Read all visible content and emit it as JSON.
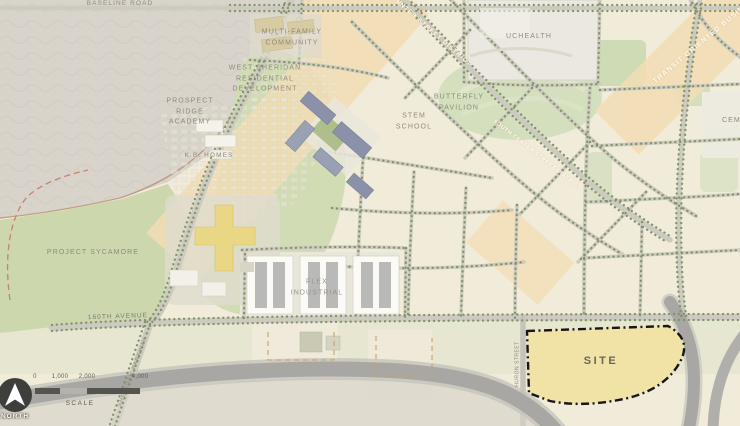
{
  "map": {
    "labels": {
      "baseline_road": "BASELINE ROAD",
      "multi_family_community": "MULTI-FAMILY\nCOMMUNITY",
      "west_sheridan": "WEST SHERIDAN\nRESIDENTIAL\nDEVELOPMENT",
      "prospect_ridge_academy": "PROSPECT\nRIDGE\nACADEMY",
      "kb_homes": "K.B. HOMES",
      "project_sycamore": "PROJECT SYCAMORE",
      "avenue_160th": "160TH AVENUE",
      "sheridan_parkway": "SHERIDAN PARKWAY",
      "flex_industrial": "FLEX\nINDUSTRIAL",
      "stem_school": "STEM\nSCHOOL",
      "butterfly_pavilion": "BUTTERFLY\nPAVILION",
      "uchealth": "UCHEALTH",
      "cemetery": "CEMETERY",
      "center_street_district": "CENTER STREET DISTRICT",
      "south_center_street_district": "SOUTH CENTER STREET DISTRICT",
      "transit_oriented_business": "TRANSIT ORIENTED BUSINESS",
      "huron_street": "HURON STREET",
      "site": "SITE"
    },
    "colors": {
      "base_cream": "#f1ecd9",
      "existing_neighborhood_gray": "#d8d4cb",
      "open_space_green": "#ccd7ae",
      "corridor_orange": "#f3ddb5",
      "site_yellow": "#f1e3a6",
      "site_border": "#161616",
      "road_gray": "#cdcabf",
      "highway_gray": "#a8a7a3",
      "tree_dot_green": "#7e9065",
      "boundary_dash_red": "#c8826a",
      "label_gray": "#8f8a7b"
    }
  },
  "scale_bar": {
    "ticks": [
      "0",
      "1,000",
      "2,000",
      "4,000"
    ],
    "label": "SCALE"
  },
  "north_arrow": {
    "label": "NORTH"
  }
}
